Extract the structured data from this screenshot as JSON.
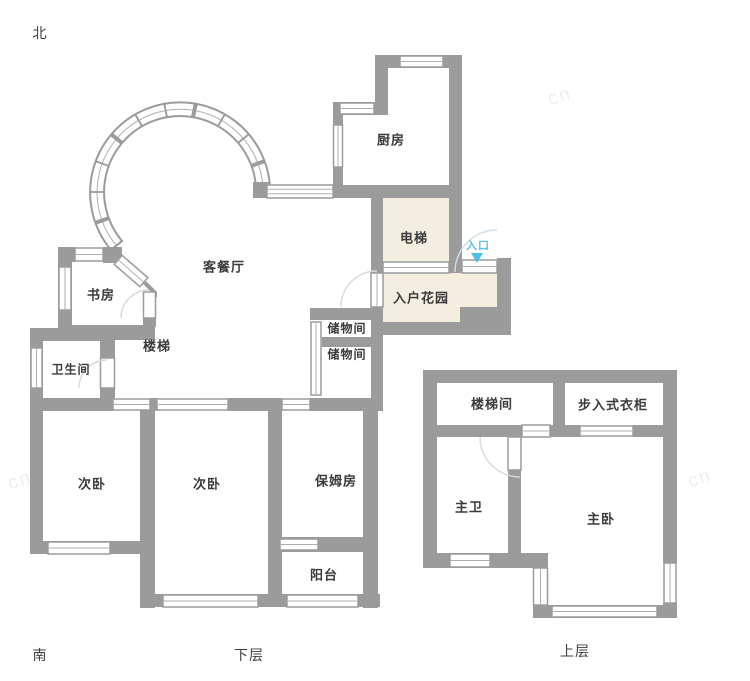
{
  "compass": {
    "north": "北",
    "south": "南"
  },
  "floors": {
    "lower": "下层",
    "upper": "上层"
  },
  "entrance": {
    "label": "入口"
  },
  "rooms": {
    "study": "书房",
    "living_dining": "客餐厅",
    "kitchen": "厨房",
    "elevator": "电梯",
    "entry_garden": "入户花园",
    "storage_1": "储物间",
    "storage_2": "储物间",
    "stairs": "楼梯",
    "bathroom": "卫生间",
    "bedroom_1": "次卧",
    "bedroom_2": "次卧",
    "nanny_room": "保姆房",
    "balcony": "阳台",
    "stairwell": "楼梯间",
    "walk_in_closet": "步入式衣柜",
    "master_bath": "主卫",
    "master_bedroom": "主卧"
  },
  "colors": {
    "wall_gray": "#9b9b9b",
    "area_beige": "#f4eee1",
    "entrance_blue": "#56c2e6",
    "label_dark": "#3b3b3b"
  },
  "watermark": "cn"
}
